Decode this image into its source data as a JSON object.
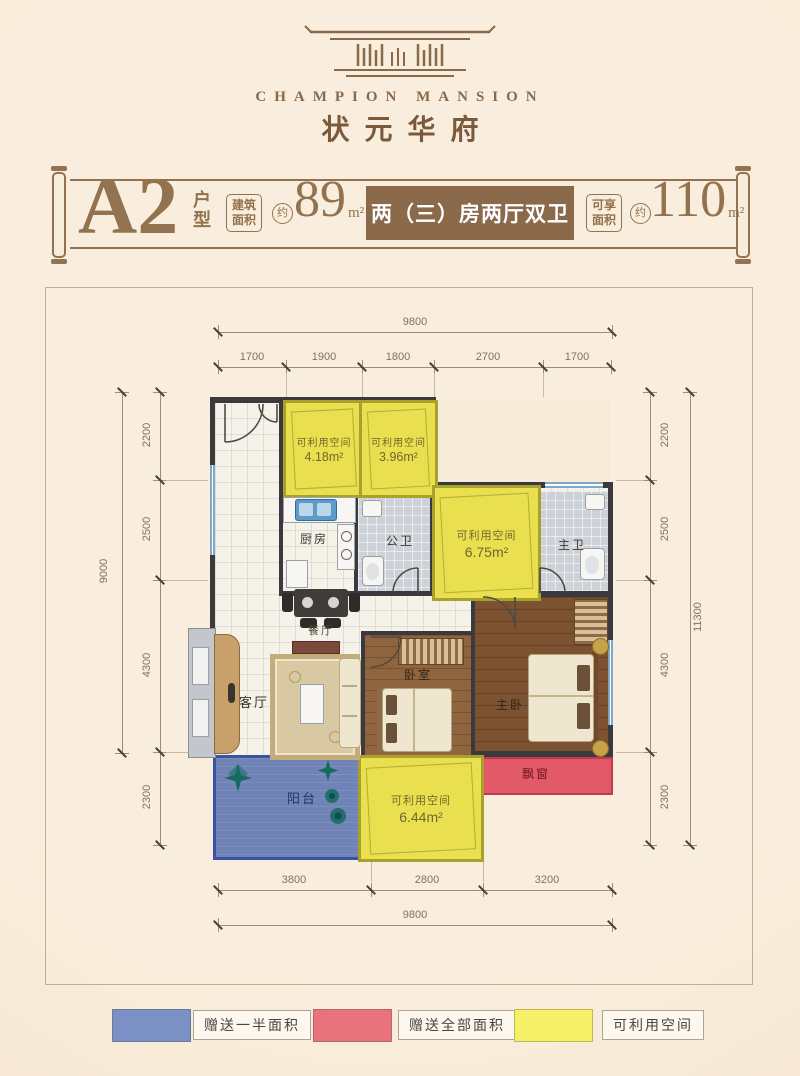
{
  "brand": {
    "name_en": "CHAMPION MANSION",
    "name_zh": "状元华府"
  },
  "title": {
    "unit": "A2",
    "unit_type": "户型",
    "area_build_label": "建筑面积",
    "approx1": "约",
    "area_build_value": "89",
    "area_build_unit": "m²",
    "layout_desc": "两（三）房两厅双卫",
    "area_enjoy_label": "可享面积",
    "approx2": "约",
    "area_enjoy_value": "110",
    "area_enjoy_unit": "m²"
  },
  "dimensions": {
    "top_total": "9800",
    "top_segments": [
      "1700",
      "1900",
      "1800",
      "2700",
      "1700"
    ],
    "left_total": "9000",
    "left_segments": [
      "2200",
      "2500",
      "4300",
      "2300"
    ],
    "right_total": "11300",
    "right_segments": [
      "2200",
      "2500",
      "4300",
      "2300"
    ],
    "bottom_total": "9800",
    "bottom_segments": [
      "3800",
      "2800",
      "3200"
    ]
  },
  "plan": {
    "rooms": {
      "kitchen": "厨房",
      "public_bath": "公卫",
      "master_bath": "主卫",
      "dining": "餐厅",
      "living": "客厅",
      "bedroom": "卧室",
      "master_bedroom": "主卧",
      "balcony": "阳台",
      "bay_window": "飘窗"
    },
    "usable_spaces": {
      "a": {
        "label": "可利用空间",
        "area": "4.18m²"
      },
      "b": {
        "label": "可利用空间",
        "area": "3.96m²"
      },
      "c": {
        "label": "可利用空间",
        "area": "6.75m²"
      },
      "d": {
        "label": "可利用空间",
        "area": "6.44m²"
      }
    }
  },
  "legend": {
    "items": [
      {
        "label": "赠送一半面积",
        "color": "#7b90c4"
      },
      {
        "label": "赠送全部面积",
        "color": "#e8737d"
      },
      {
        "label": "可利用空间",
        "color": "#f6ef68"
      }
    ]
  },
  "colors": {
    "accent_brown": "#8a6a4b",
    "wall": "#3a393d",
    "usable_yellow": "#e9df4f",
    "balcony_blue": "#7083b7",
    "bay_red": "#e25a68"
  }
}
